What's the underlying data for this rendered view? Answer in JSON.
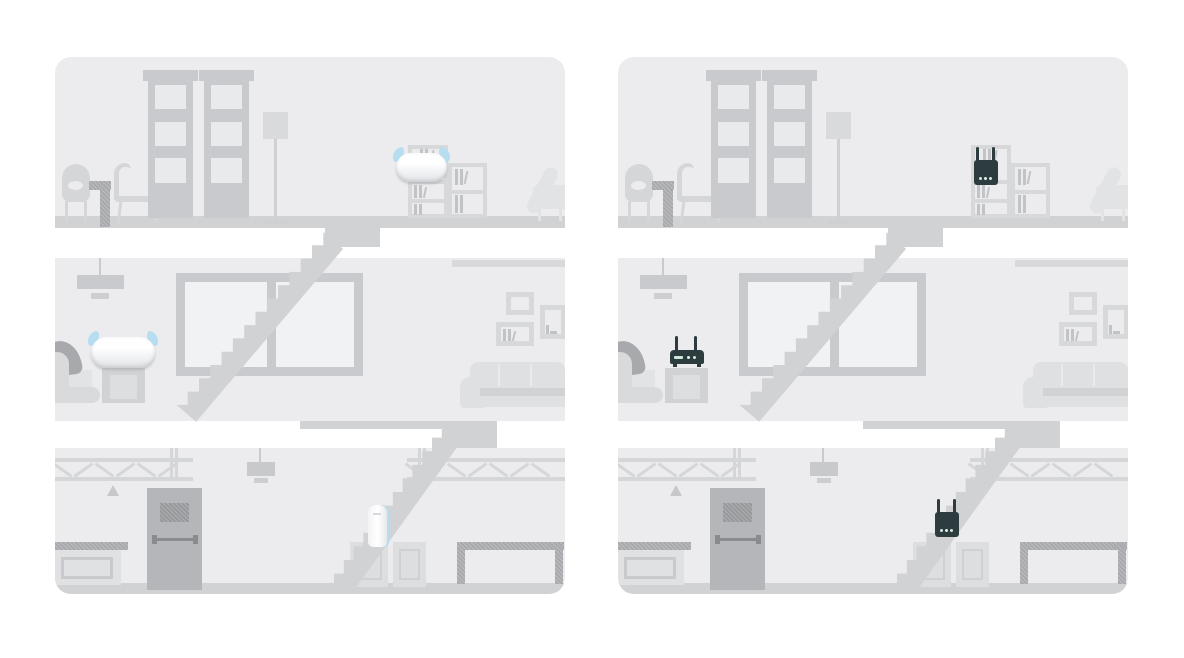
{
  "illustration": {
    "kind": "whole-home-wifi-coverage-comparison",
    "panels": [
      {
        "id": "mesh-wifi-home",
        "house": "three-storey-cutaway",
        "floors": [
          {
            "name": "top-floor",
            "device": {
              "type": "mesh-node",
              "style": "mesh-pill",
              "wifi_indicator": true,
              "location": "bookshelf"
            }
          },
          {
            "name": "middle-floor",
            "device": {
              "type": "mesh-node",
              "style": "mesh-pill",
              "wifi_indicator": true,
              "location": "side-table"
            }
          },
          {
            "name": "bottom-floor",
            "device": {
              "type": "mesh-node",
              "style": "mesh-tower",
              "wifi_indicator": false,
              "location": "storage-boxes"
            }
          }
        ]
      },
      {
        "id": "router-extender-home",
        "house": "three-storey-cutaway",
        "floors": [
          {
            "name": "top-floor",
            "device": {
              "type": "range-extender",
              "style": "extender-vertical",
              "wifi_indicator": false,
              "location": "bookshelf"
            }
          },
          {
            "name": "middle-floor",
            "device": {
              "type": "router",
              "style": "router-horizontal",
              "wifi_indicator": false,
              "location": "side-table"
            }
          },
          {
            "name": "bottom-floor",
            "device": {
              "type": "range-extender",
              "style": "extender-vertical",
              "wifi_indicator": false,
              "location": "storage-boxes"
            }
          }
        ]
      }
    ],
    "colors": {
      "page_bg": "#ffffff",
      "room_bg": "#ececee",
      "floor": "#d1d2d4",
      "ceiling": "#d8d9db",
      "furniture_light": "#dfe0e2",
      "furniture_mid": "#d5d6d8",
      "outline": "#c9cacd",
      "shelf_line": "#d7d8da",
      "books": "#c2c3c6",
      "pane": "#f1f2f4",
      "accent_dark": "#a8a9ac",
      "door": "#b5b6b9",
      "door_window": "#97989b",
      "push_bar": "#8a8b8e",
      "device_dark": "#2c3c3f",
      "device_white": "#ffffff",
      "device_white_shade": "#e2e4e7",
      "wifi_blue": "#b7ddf0",
      "led_green": "#cdeadb"
    }
  }
}
